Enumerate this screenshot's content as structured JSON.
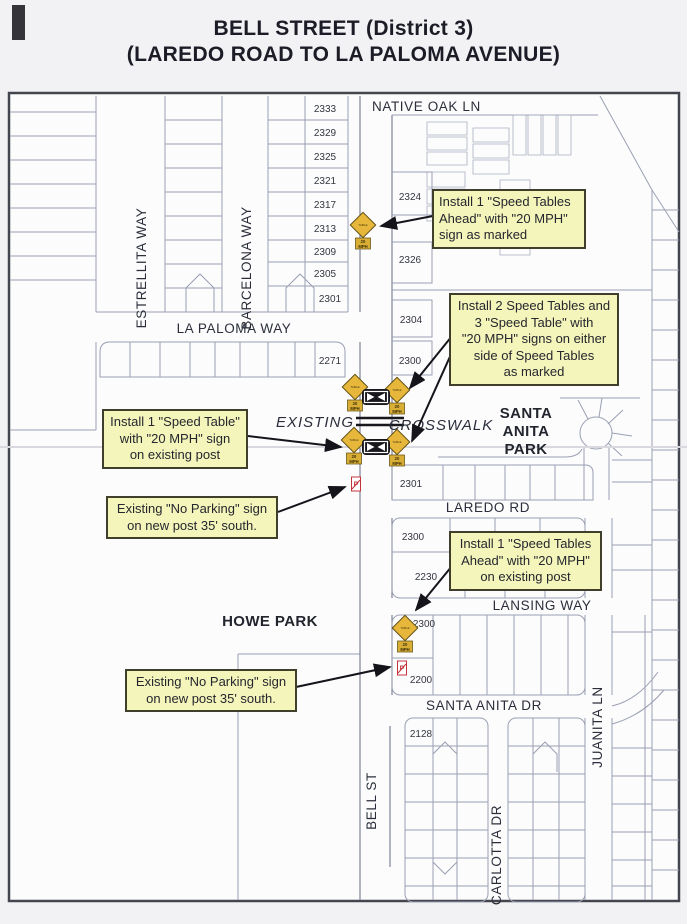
{
  "title": {
    "line1": "BELL STREET (District 3)",
    "line2": "(LAREDO ROAD TO LA PALOMA AVENUE)"
  },
  "streets": {
    "native_oak_ln": "NATIVE OAK LN",
    "estrellita_way": "ESTRELLITA WAY",
    "barcelona_way": "BARCELONA WAY",
    "la_paloma_way": "LA PALOMA WAY",
    "laredo_rd": "LAREDO RD",
    "lansing_way": "LANSING WAY",
    "santa_anita_dr": "SANTA ANITA DR",
    "bell_st": "BELL ST",
    "carlotta_dr": "CARLOTTA DR",
    "juanita_ln": "JUANITA LN"
  },
  "areas": {
    "santa_anita_park": [
      "SANTA",
      "ANITA",
      "PARK"
    ],
    "howe_park": "HOWE PARK",
    "existing": "EXISTING",
    "crosswalk": "CROSSWALK"
  },
  "callouts": {
    "speed_tables_ahead_north": "Install 1 \"Speed Tables\nAhead\" with \"20 MPH\"\nsign as marked",
    "speed_tables_crosswalk": "Install 2 Speed Tables and\n3 \"Speed Table\" with\n\"20 MPH\" signs on either\nside of Speed Tables\nas marked",
    "speed_table_existing_post": "Install 1 \"Speed Table\"\nwith \"20 MPH\" sign\non existing post",
    "no_parking_north": "Existing \"No Parking\" sign\non new post 35' south.",
    "speed_tables_ahead_south": "Install 1 \"Speed Tables\nAhead\" with \"20 MPH\"\non existing post",
    "no_parking_south": "Existing \"No Parking\" sign\non new post 35' south."
  },
  "lot_numbers": {
    "bell_west": [
      "2333",
      "2329",
      "2325",
      "2321",
      "2317",
      "2313",
      "2309",
      "2305",
      "2301"
    ],
    "la_paloma_south": "2271",
    "bell_east_north": [
      "2324",
      "2326",
      "2304",
      "2300"
    ],
    "laredo_north": "2301",
    "laredo_south": [
      "2300",
      "2230"
    ],
    "lansing_south": [
      "2300",
      "2200"
    ],
    "santa_anita_south": "2128"
  },
  "signs": {
    "speed_table_diamond": "TABLE",
    "mph_plaque_line1": "20",
    "mph_plaque_line2": "MPH",
    "no_parking": "P"
  },
  "colors": {
    "callout_bg": "#f3f5bb",
    "callout_border": "#3f3f2c",
    "sign_yellow": "#e6b73a",
    "sign_red": "#c4343c",
    "map_line": "#9aa0b2",
    "ink": "#17171d"
  }
}
